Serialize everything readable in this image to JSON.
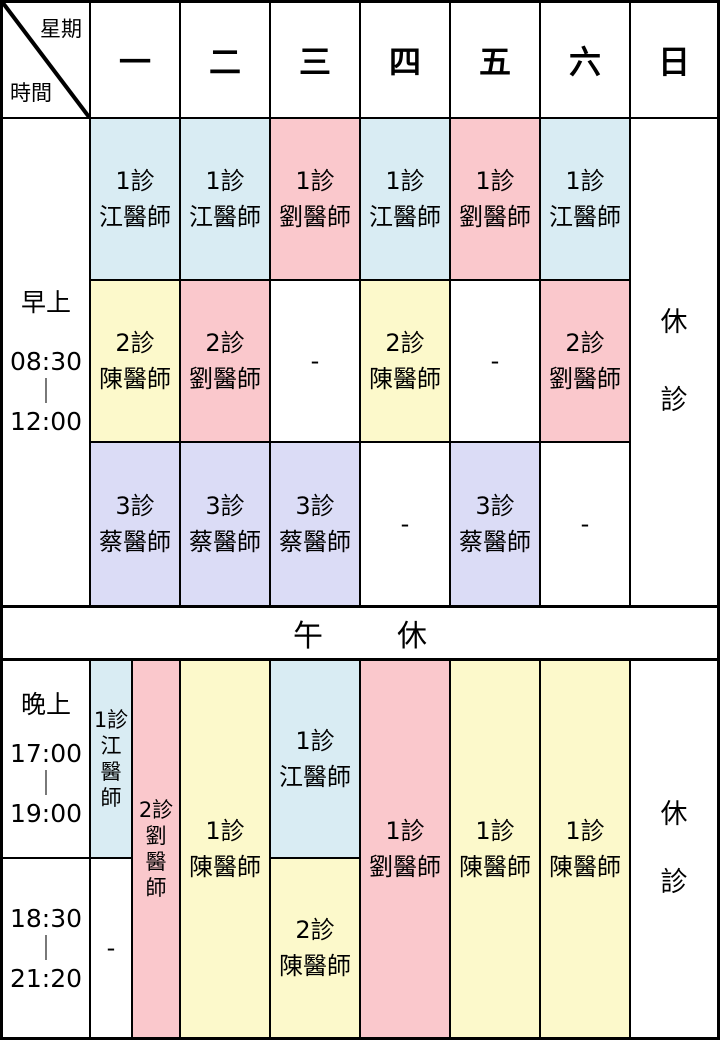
{
  "colors": {
    "blue": "#d9ecf3",
    "pink": "#fac8cc",
    "yellow": "#fcf9cb",
    "lavender": "#dbdcf6",
    "white": "#ffffff",
    "line": "#000000"
  },
  "symbols": {
    "dash": "-",
    "time_separator": "｜"
  },
  "header": {
    "corner_top_right": "星期",
    "corner_bottom_left": "時間",
    "days": [
      "一",
      "二",
      "三",
      "四",
      "五",
      "六",
      "日"
    ]
  },
  "morning": {
    "period_label": "早上",
    "time_start": "08:30",
    "time_end": "12:00",
    "rows": [
      [
        {
          "room": "1診",
          "doctor": "江醫師",
          "color": "blue"
        },
        {
          "room": "1診",
          "doctor": "江醫師",
          "color": "blue"
        },
        {
          "room": "1診",
          "doctor": "劉醫師",
          "color": "pink"
        },
        {
          "room": "1診",
          "doctor": "江醫師",
          "color": "blue"
        },
        {
          "room": "1診",
          "doctor": "劉醫師",
          "color": "pink"
        },
        {
          "room": "1診",
          "doctor": "江醫師",
          "color": "blue"
        }
      ],
      [
        {
          "room": "2診",
          "doctor": "陳醫師",
          "color": "yellow"
        },
        {
          "room": "2診",
          "doctor": "劉醫師",
          "color": "pink"
        },
        {
          "dash": "-",
          "color": "white"
        },
        {
          "room": "2診",
          "doctor": "陳醫師",
          "color": "yellow"
        },
        {
          "dash": "-",
          "color": "white"
        },
        {
          "room": "2診",
          "doctor": "劉醫師",
          "color": "pink"
        }
      ],
      [
        {
          "room": "3診",
          "doctor": "蔡醫師",
          "color": "lavender"
        },
        {
          "room": "3診",
          "doctor": "蔡醫師",
          "color": "lavender"
        },
        {
          "room": "3診",
          "doctor": "蔡醫師",
          "color": "lavender"
        },
        {
          "dash": "-",
          "color": "white"
        },
        {
          "room": "3診",
          "doctor": "蔡醫師",
          "color": "lavender"
        },
        {
          "dash": "-",
          "color": "white"
        }
      ]
    ],
    "sunday_rest": [
      "休",
      "診"
    ]
  },
  "lunch": {
    "chars": [
      "午",
      "休"
    ]
  },
  "evening": {
    "period_label": "晚上",
    "slot1": {
      "start": "17:00",
      "end": "19:00"
    },
    "slot2": {
      "start": "18:30",
      "end": "21:20"
    },
    "monday_room1_early": {
      "room": "1診",
      "chars": [
        "江",
        "醫",
        "師"
      ],
      "color": "blue"
    },
    "monday_room1_late": {
      "dash": "-",
      "color": "white"
    },
    "monday_room2": {
      "room": "2診",
      "chars": [
        "劉",
        "醫",
        "師"
      ],
      "color": "pink"
    },
    "tuesday": {
      "room": "1診",
      "doctor": "陳醫師",
      "color": "yellow"
    },
    "wednesday_early": {
      "room": "1診",
      "doctor": "江醫師",
      "color": "blue"
    },
    "wednesday_late": {
      "room": "2診",
      "doctor": "陳醫師",
      "color": "yellow"
    },
    "thursday": {
      "room": "1診",
      "doctor": "劉醫師",
      "color": "pink"
    },
    "friday": {
      "room": "1診",
      "doctor": "陳醫師",
      "color": "yellow"
    },
    "saturday": {
      "room": "1診",
      "doctor": "陳醫師",
      "color": "yellow"
    },
    "sunday_rest": [
      "休",
      "診"
    ]
  }
}
